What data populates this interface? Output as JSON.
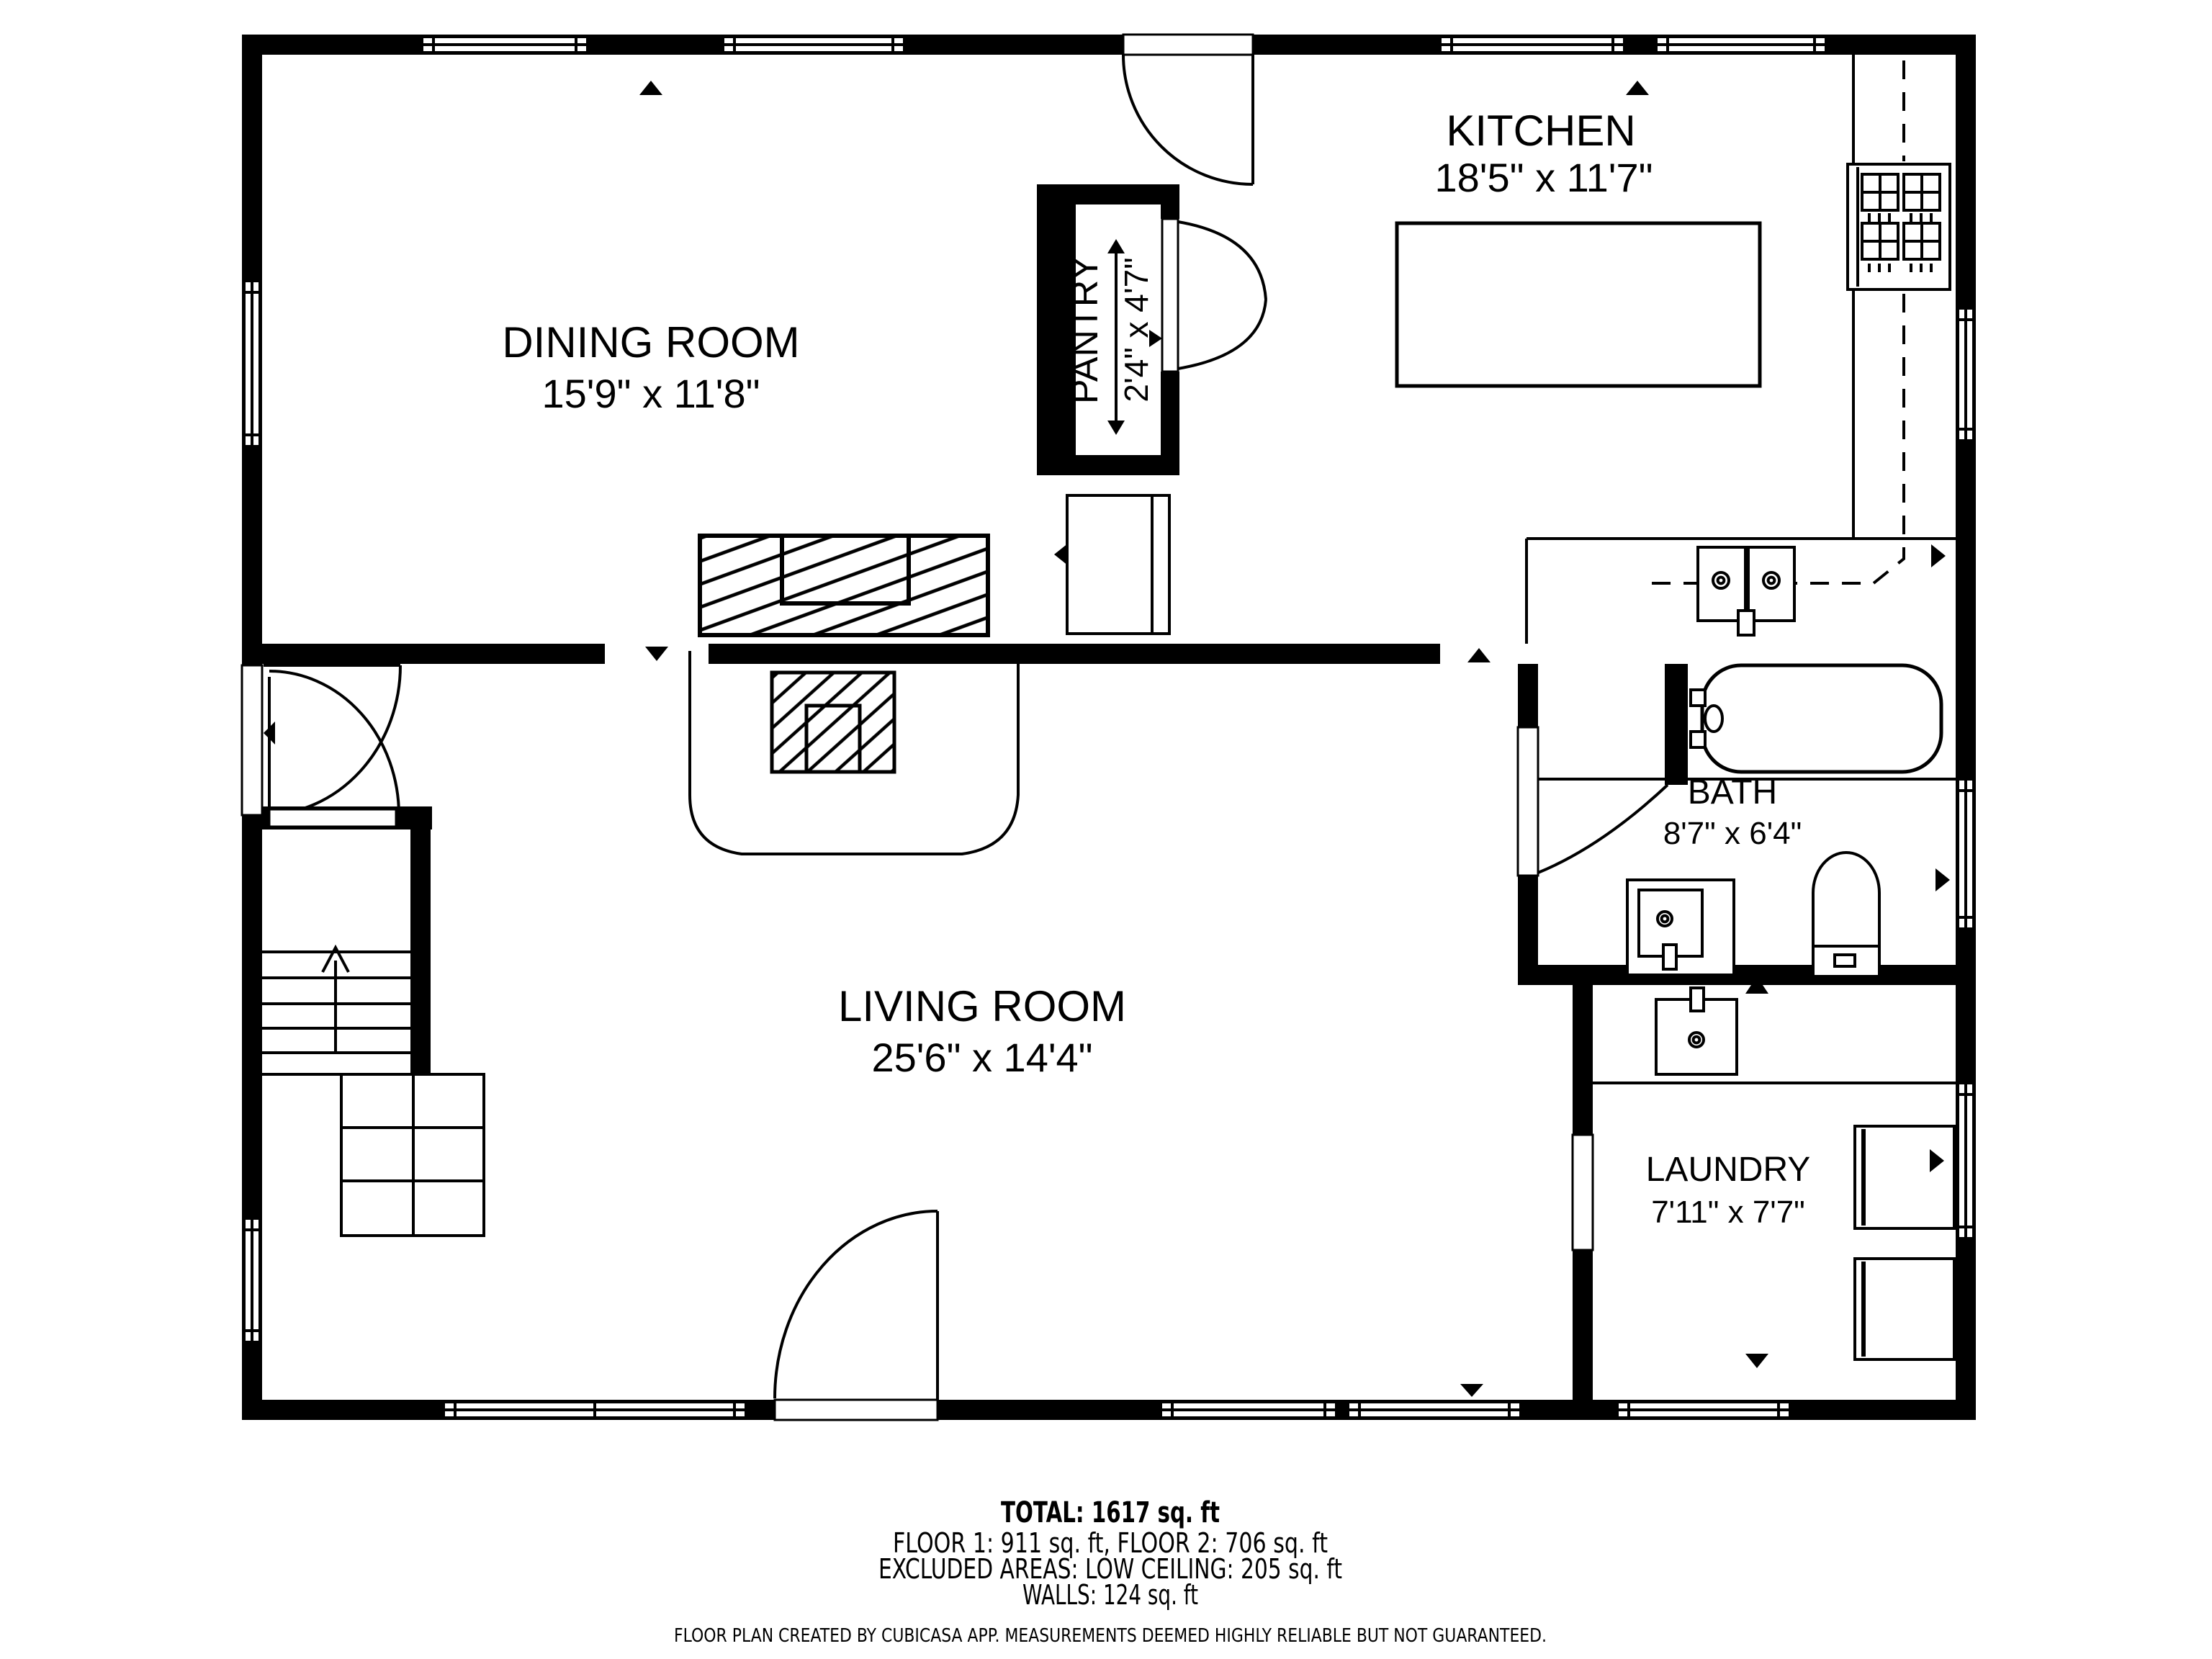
{
  "rooms": [
    {
      "name": "DINING ROOM",
      "dims": "15'9\" x 11'8\""
    },
    {
      "name": "KITCHEN",
      "dims": "18'5\" x 11'7\""
    },
    {
      "name": "PANTRY",
      "dims": "2'4\" x 4'7\""
    },
    {
      "name": "LIVING ROOM",
      "dims": "25'6\" x 14'4\""
    },
    {
      "name": "BATH",
      "dims": "8'7\" x 6'4\""
    },
    {
      "name": "LAUNDRY",
      "dims": "7'11\" x 7'7\""
    }
  ],
  "summary": {
    "total": "TOTAL: 1617 sq. ft",
    "floors": "FLOOR 1: 911 sq. ft, FLOOR 2: 706 sq. ft",
    "excluded": "EXCLUDED AREAS: LOW CEILING: 205 sq. ft",
    "walls": "WALLS: 124 sq. ft"
  },
  "disclaimer": "FLOOR PLAN CREATED BY CUBICASA APP. MEASUREMENTS DEEMED HIGHLY RELIABLE BUT NOT GUARANTEED.",
  "colors": {
    "wall": "#000000",
    "background": "#ffffff",
    "line": "#000000"
  },
  "fixtures": [
    "stove-icon",
    "kitchen-sink-icon",
    "kitchen-island",
    "bathtub-icon",
    "toilet-icon",
    "vanity-sink-icon",
    "laundry-sink-icon",
    "washer-icon",
    "dryer-icon",
    "fireplace",
    "stairs-icon",
    "pantry-doors",
    "entry-doors"
  ]
}
